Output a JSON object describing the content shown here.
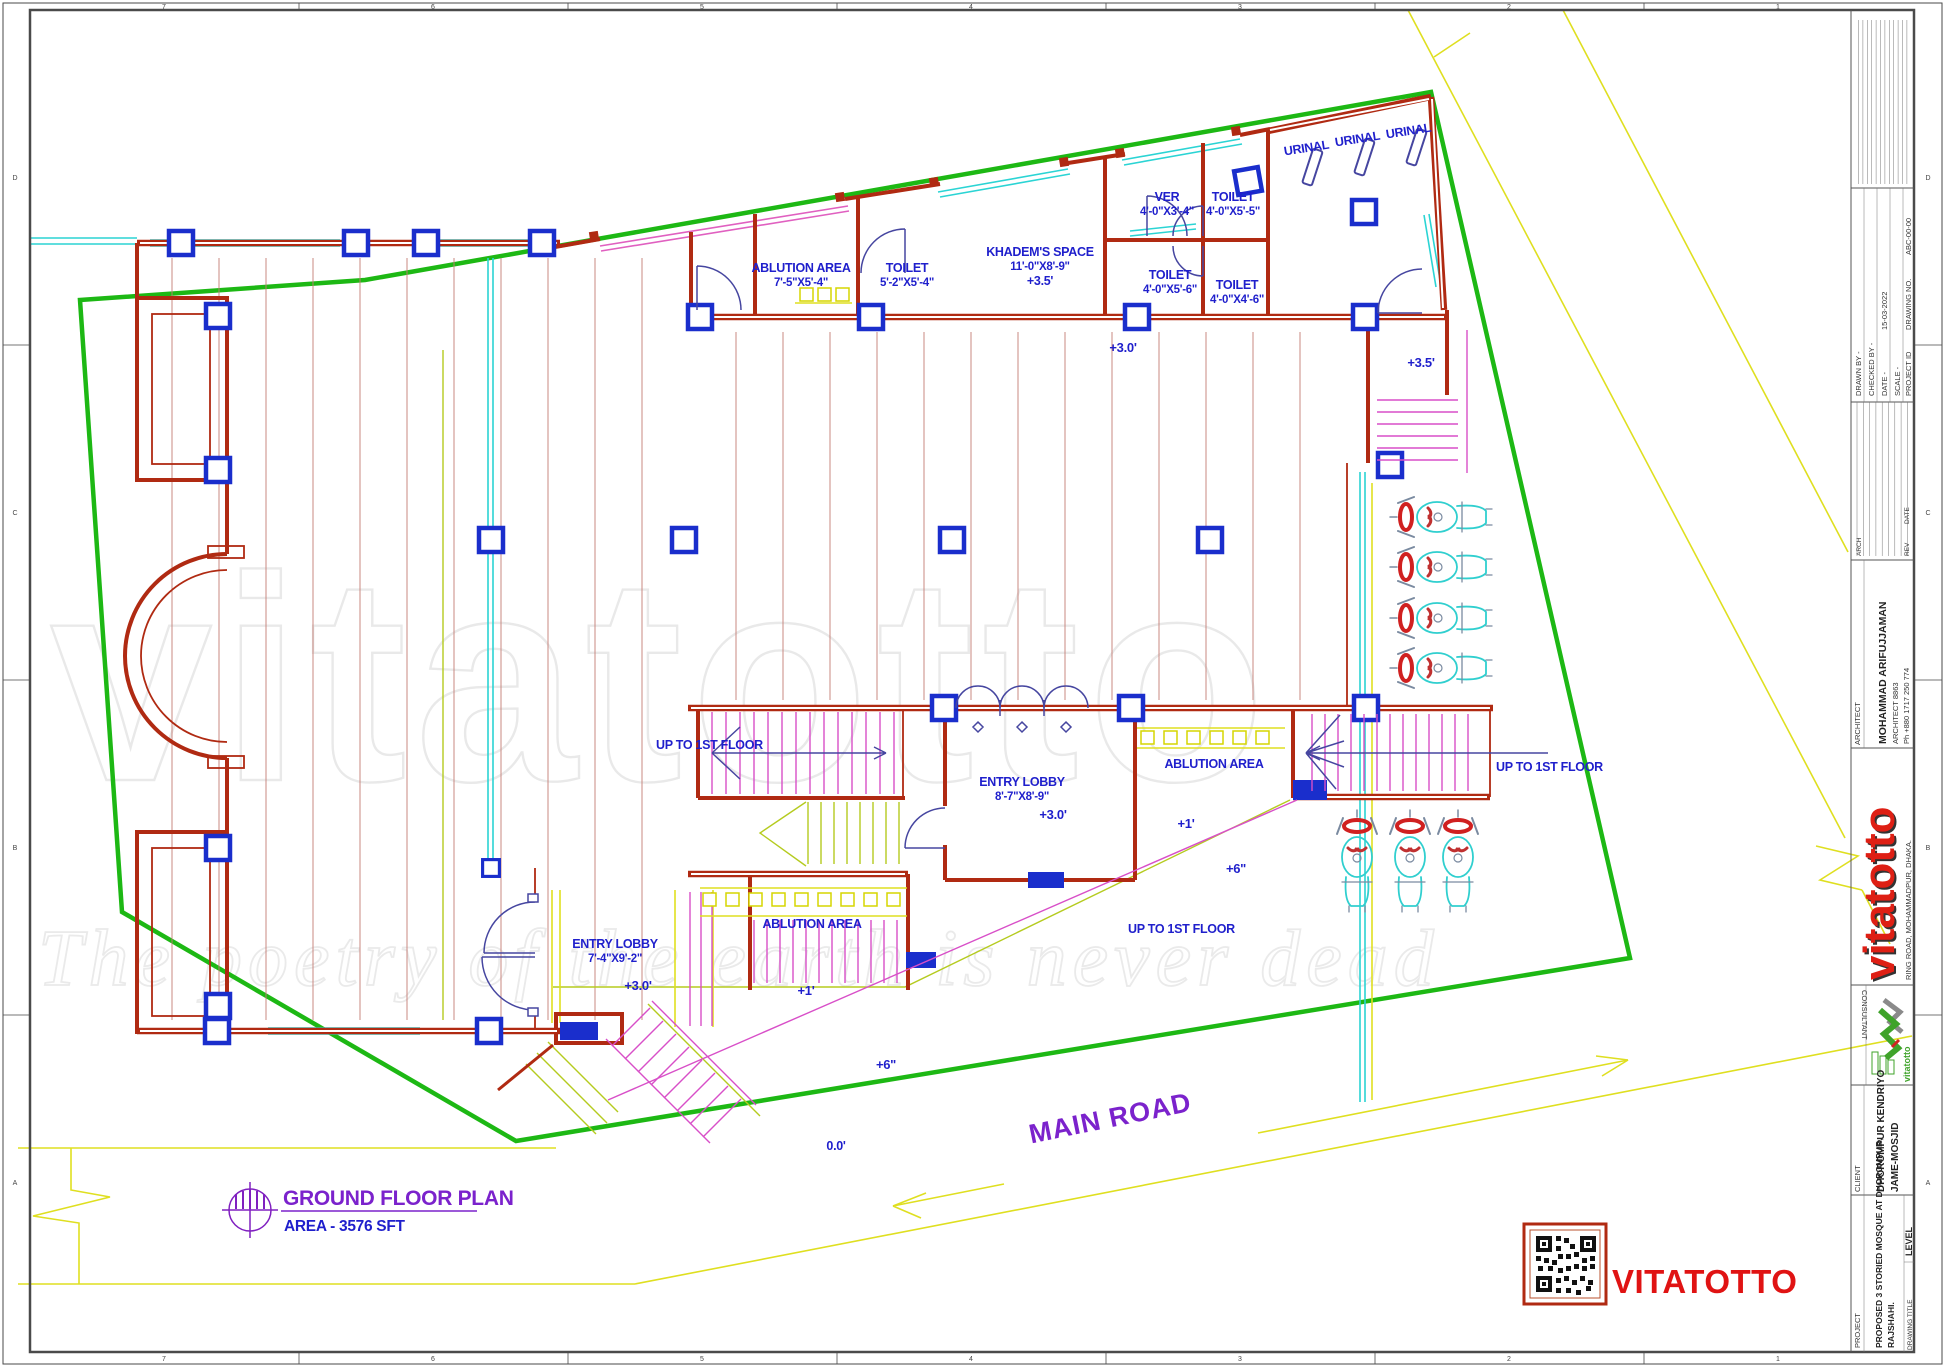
{
  "sheet": {
    "grid_columns": [
      "7",
      "6",
      "5",
      "4",
      "3",
      "2",
      "1"
    ],
    "grid_rows": [
      "D",
      "C",
      "B",
      "A"
    ]
  },
  "titleblock": {
    "drawn_by": "DRAWN BY -",
    "checked_by": "CHECKED BY -",
    "date_label": "DATE -",
    "date_value": "15-03-2022",
    "scale_label": "SCALE -",
    "project_id_label": "PROJECT ID",
    "drawing_no_label": "DRAWING NO.",
    "drawing_no_value": "ABC-00-00",
    "arch_label": "ARCH",
    "rev_label": "REV",
    "rev_date_label": "DATE",
    "architect_header": "ARCHITECT",
    "architect_name": "MOHAMMAD ARIFUJJAMAN",
    "architect_reg": "ARCHITECT 8863",
    "architect_phone": "Ph +880 1717 250 774",
    "brand_wordmark": "vitatotto",
    "brand_address": "RING ROAD, MOHAMMADPUR, DHAKA.",
    "consultant_label": "CONSULTANT",
    "consultant_wordmark": "vitatotto",
    "client_header": "CLIENT",
    "client_name_line1": "DHOROMPUR KENDRIYO",
    "client_name_line2": "JAME-MOSJID",
    "project_header": "PROJECT",
    "project_name_line1": "PROPOSED 3 STORIED MOSQUE  AT DHOROMPUR,",
    "project_name_line2": "RAJSHAHI.",
    "drawing_title_label": "DRAWING TITLE",
    "level_label": "LEVEL"
  },
  "plan": {
    "rooms": {
      "ablution_top": {
        "name": "ABLUTION AREA",
        "dim": "7'-5\"X5'-4\""
      },
      "toilet_top": {
        "name": "TOILET",
        "dim": "5'-2\"X5'-4\""
      },
      "khadem": {
        "name": "KHADEM'S SPACE",
        "dim": "11'-0\"X8'-9\"",
        "level": "+3.5'"
      },
      "ver": {
        "name": "VER",
        "dim": "4'-0\"X3'-4\""
      },
      "toilet_ne1": {
        "name": "TOILET",
        "dim": "4'-0\"X5'-5\""
      },
      "toilet_ne2": {
        "name": "TOILET",
        "dim": "4'-0\"X5'-6\""
      },
      "toilet_ne3": {
        "name": "TOILET",
        "dim": "4'-0\"X4'-6\""
      },
      "urinal": "URINAL",
      "entry_lobby_center": {
        "name": "ENTRY LOBBY",
        "dim": "8'-7\"X8'-9\""
      },
      "entry_lobby_left": {
        "name": "ENTRY LOBBY",
        "dim": "7'-4\"X9'-2\""
      },
      "ablution_center": "ABLUTION AREA",
      "ablution_right": "ABLUTION AREA",
      "up_to_1st_floor": "UP TO 1ST FLOOR"
    },
    "levels": {
      "hall": "+3.0'",
      "verandah": "+3.5'",
      "terrace_1": "+1'",
      "terrace_6": "+6\"",
      "ground": "0.0'"
    }
  },
  "site": {
    "main_road": "MAIN ROAD"
  },
  "footer": {
    "plan_title": "GROUND FLOOR PLAN",
    "plan_area": "AREA - 3576 SFT",
    "stamp_text": "VITATOTTO"
  },
  "watermark": {
    "word": "vitatotto",
    "tagline": "The poetry of the earth is never dead"
  },
  "colors": {
    "boundary_green": "#1DB814",
    "wall_red": "#B02A12",
    "column_blue": "#1A2ECC",
    "window_cyan": "#2BD4D4",
    "stair_magenta": "#D84FC8",
    "road_yellow": "#DFDF20",
    "label_blue": "#1F1FCC",
    "accent_purple": "#7B22CC",
    "stamp_red": "#E01313"
  }
}
